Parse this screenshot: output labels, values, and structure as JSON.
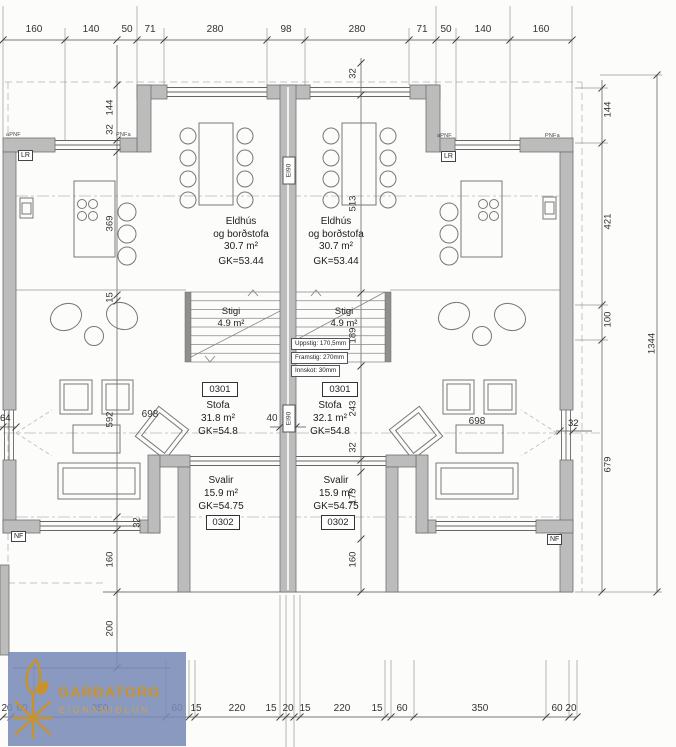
{
  "dimensions": {
    "top": [
      "160",
      "140",
      "50",
      "71",
      "280",
      "98",
      "280",
      "71",
      "50",
      "140",
      "160"
    ],
    "bottom": [
      "20",
      "60",
      "350",
      "60",
      "15",
      "220",
      "15",
      "20",
      "15",
      "220",
      "15",
      "60",
      "350",
      "60",
      "20"
    ],
    "left_chain": [
      "144",
      "32",
      "369",
      "15",
      "592",
      "32",
      "160",
      "200"
    ],
    "center_chain": [
      "32",
      "513",
      "189",
      "243",
      "32",
      "175",
      "160"
    ],
    "right_chain": [
      "144",
      "421",
      "100",
      "679"
    ],
    "overall": "1344",
    "left_wall": "64",
    "party_wall": "40",
    "sofa_left": "698",
    "sofa_right": "698",
    "right_wall": "32",
    "bottom_wall": "32"
  },
  "left_unit": {
    "kitchen": {
      "line1": "Eldhús",
      "line2": "og borðstofa",
      "area": "30.7 m²",
      "level": "GK=53.44"
    },
    "stair": {
      "name": "Stigi",
      "area": "4.9 m²"
    },
    "living": {
      "number": "0301",
      "name": "Stofa",
      "area": "31.8 m²",
      "level": "GK=54.8"
    },
    "balcony": {
      "name": "Svalir",
      "area": "15.9 m²",
      "level": "GK=54.75",
      "number": "0302"
    }
  },
  "right_unit": {
    "kitchen": {
      "line1": "Eldhús",
      "line2": "og borðstofa",
      "area": "30.7 m²",
      "level": "GK=53.44"
    },
    "stair": {
      "name": "Stigi",
      "area": "4.9 m²"
    },
    "living": {
      "number": "0301",
      "name": "Stofa",
      "area": "32.1 m²",
      "level": "GK=54.8"
    },
    "balcony": {
      "name": "Svalir",
      "area": "15.9 m²",
      "level": "GK=54.75",
      "number": "0302"
    }
  },
  "stair_specs": {
    "rise": "Uppstig: 170,5mm",
    "going": "Framstig: 270mm",
    "nosing": "Innskot: 30mm"
  },
  "labels": {
    "fire_top": "EI90",
    "fire_mid": "EI90",
    "lr_left": "LR",
    "lr_right": "LR",
    "nf_left": "NF",
    "nf_right": "NF",
    "pnf_tl": "aPNF",
    "pnf_tl2": "PNFa",
    "pnf_tr": "aPNF",
    "pnf_tr2": "PNFa"
  },
  "logo": {
    "brand": "GARÐATORG",
    "tagline": "EIGNAMIÐLUN",
    "accent": "#c9932b",
    "bg": "#7a8bb7"
  }
}
